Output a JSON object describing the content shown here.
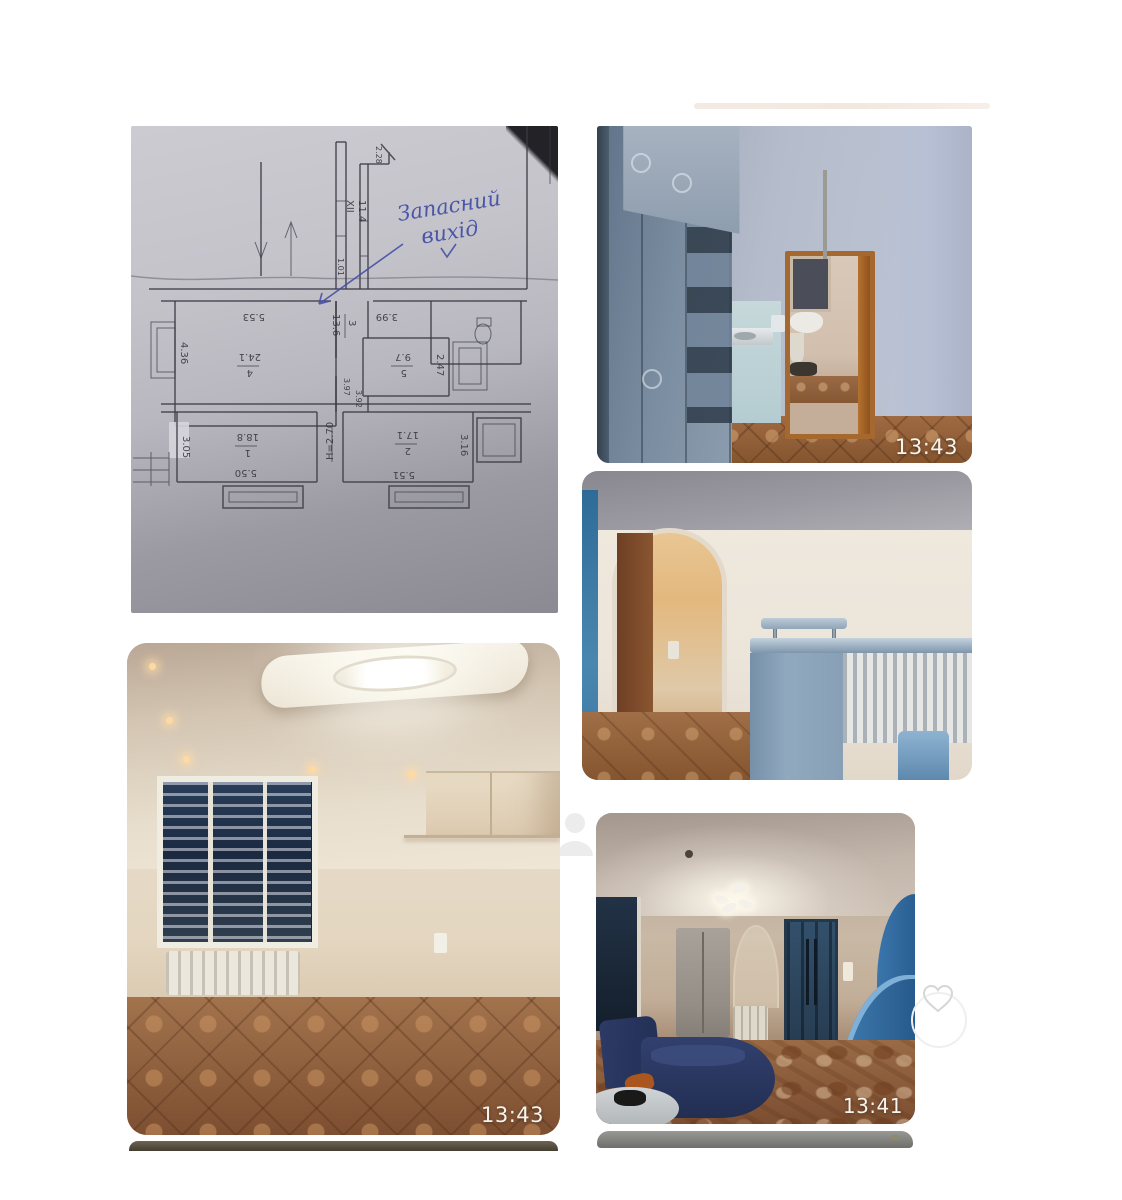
{
  "photos": {
    "floor_plan": {
      "annotation": {
        "line1": "Запасний",
        "line2": "вихід"
      },
      "rooms": [
        {
          "num": "1",
          "area": "18.8"
        },
        {
          "num": "2",
          "area": "17.1"
        },
        {
          "num": "3",
          "area": "13.6"
        },
        {
          "num": "4",
          "area": "24.1"
        },
        {
          "num": "5",
          "area": "9.7"
        }
      ],
      "dims": {
        "w436": "4.36",
        "w553": "5.53",
        "w305": "3.05",
        "w550": "5.50",
        "w551": "5.51",
        "w316": "3.16",
        "w247": "2.47",
        "w399": "3.99",
        "height_mark": "H=2.70",
        "corridor_roman": "XII",
        "corridor_len": "11.4",
        "w228": "2.28",
        "w397": "3.97",
        "w392": "3.92",
        "w101": "1.01"
      }
    },
    "hallway": {
      "timestamp": "13:43"
    },
    "empty_room": {
      "timestamp": "13:43"
    },
    "living_room": {
      "timestamp": "13:41"
    }
  },
  "icons": {
    "avatar": "person-icon",
    "favorite": "heart-icon"
  },
  "colors": {
    "timestamp_text": "#f7f4ed",
    "handwriting_blue": "#4450a6",
    "floor_tile_brown": "#96663f",
    "bar_counter_blue": "#90a9bf",
    "wave_wall_blue": "#2f6ba3",
    "door_navy": "#2c4258"
  }
}
